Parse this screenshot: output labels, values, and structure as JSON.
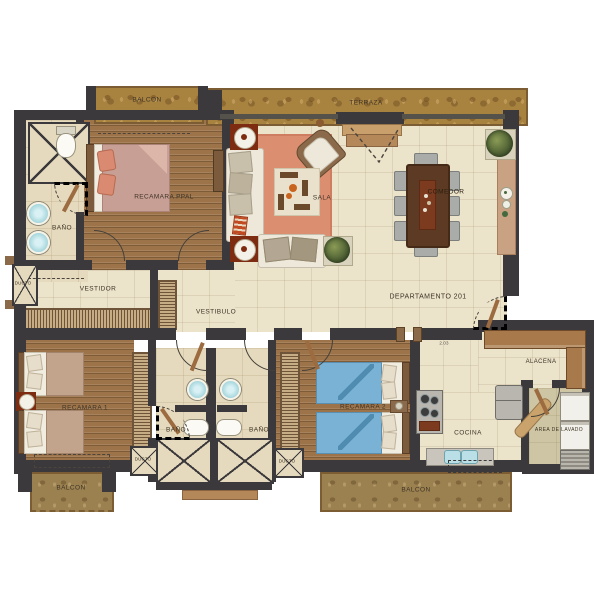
{
  "unit": {
    "label": "DEPARTAMENTO 201"
  },
  "rooms": {
    "balcon_tl": "BALCON",
    "terraza": "TERRAZA",
    "recamara_ppal": "RECAMARA PPAL",
    "bano_ppal": "BAÑO",
    "vestidor": "VESTIDOR",
    "vestibulo": "VESTIBULO",
    "sala": "SALA",
    "comedor": "COMEDOR",
    "recamara_1": "RECAMARA 1",
    "bano_1": "BAÑO",
    "bano_2": "BAÑO",
    "recamara_2": "RECAMARA 2",
    "cocina": "COCINA",
    "alacena": "ALACENA",
    "area_de_lavado": "AREA DE LAVADO",
    "balcon_bl": "BALCON",
    "balcon_b": "BALCON"
  },
  "shafts": {
    "ducto_1": "DUCTO",
    "ducto_2": "DUCTO",
    "ducto_3": "DUCTO"
  },
  "dimensions": {
    "kitchen_door": "2.03"
  },
  "colors": {
    "wall": "#3b393c",
    "tile": "#ece3cb",
    "wood": "#9d744a",
    "stone": "#a8823f",
    "rug": "#dc8e71",
    "master_bed": "#c89f94",
    "guest_bed_blue": "#79b2d4",
    "accent_red": "#7d2c12",
    "counter_wood": "#a87a4b"
  }
}
